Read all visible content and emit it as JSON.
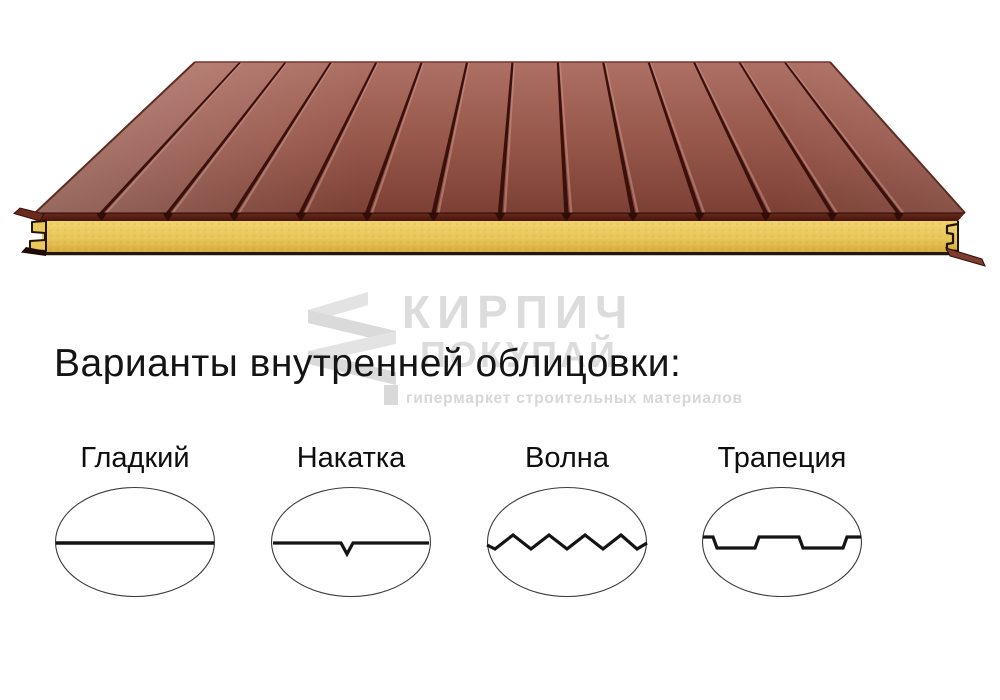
{
  "product_render": {
    "description": "3D render of a sandwich panel with ribbed metal facing and mineral-wool core",
    "ribs_count": 13,
    "colors": {
      "facing_light": "#ad7064",
      "facing_dark": "#7b4034",
      "facing_edge": "#5d2015",
      "rib_groove": "#3a1009",
      "core_yellow": "#eac85c",
      "outline": "#231409"
    }
  },
  "watermark": {
    "brand": "КИРПИЧ",
    "brand_line2": "ПОКУПАЙ",
    "tagline": "гипермаркет строительных материалов",
    "color": "#dcdcdc"
  },
  "heading": {
    "text": "Варианты внутренней облицовки:"
  },
  "options": [
    {
      "label": "Гладкий",
      "profile": "smooth"
    },
    {
      "label": "Накатка",
      "profile": "knurled"
    },
    {
      "label": "Волна",
      "profile": "wave"
    },
    {
      "label": "Трапеция",
      "profile": "trapezoid"
    }
  ]
}
